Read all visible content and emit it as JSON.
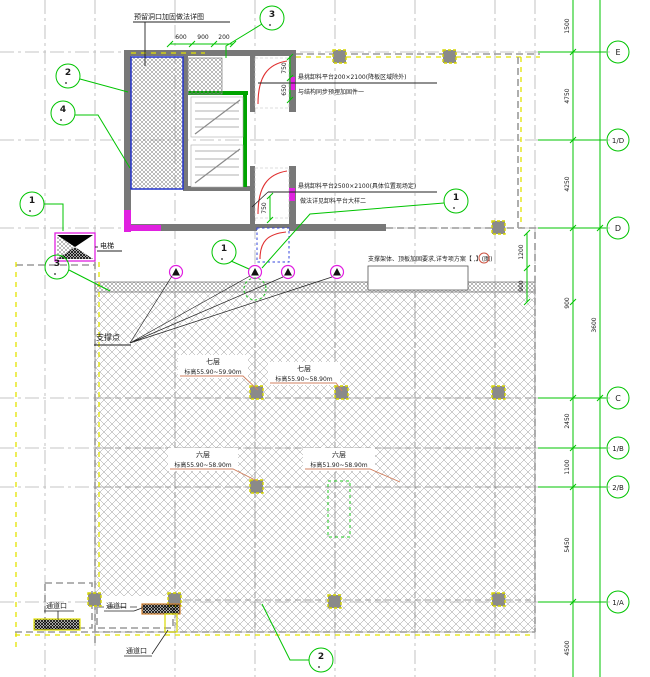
{
  "drawing_title": "楼层平台支撑布置平面图",
  "colors": {
    "grid_green": "#00c400",
    "wall_gray": "#787878",
    "accent_yellow": "#e3e300",
    "accent_magenta": "#e020e0",
    "accent_blue": "#2233cc",
    "leader_red": "#e03030"
  },
  "grid": {
    "bubbles": [
      "E",
      "1/D",
      "D",
      "C",
      "1/B",
      "2/B",
      "1/A"
    ]
  },
  "dims": {
    "right_inner": [
      "1500",
      "4750",
      "4250",
      "900",
      "2450",
      "1100",
      "5450",
      "4500"
    ],
    "right_outer": [
      "3600"
    ],
    "top": [
      "600",
      "900",
      "200"
    ],
    "v1": [
      "750",
      "650"
    ],
    "v2": [
      "750"
    ],
    "v3": [
      "1200",
      "900"
    ]
  },
  "callouts": {
    "top": "3",
    "left_upper": "2",
    "left_mid": "4",
    "left_lower": "1",
    "mid_left": "3",
    "support_a": "1",
    "support_b": "1",
    "bottom": "2"
  },
  "notes": {
    "top_note": "预留洞口加固做法详图",
    "platform1_line1": "悬挑卸料平台200×2100(降板区域除外)",
    "platform1_line2": "与结构同步预埋加固件一",
    "platform2_line1": "悬挑卸料平台2500×2100(具体位置现场定)",
    "platform2_line2": "做法详见卸料平台大样二",
    "slab_note": "支撑架体、顶板加固要求,详专项方案【 ,】(图)",
    "support_label": "支撑点",
    "hoist_label": "电梯",
    "passage1": "通道口",
    "passage2": "通道口",
    "passage3": "通道口"
  },
  "zone_tags": [
    {
      "title": "七层",
      "range": "标高55.90~59.90m"
    },
    {
      "title": "七层",
      "range": "标高55.90~58.90m"
    },
    {
      "title": "六层",
      "range": "标高55.90~58.90m"
    },
    {
      "title": "六层",
      "range": "标高51.90~58.90m"
    }
  ]
}
